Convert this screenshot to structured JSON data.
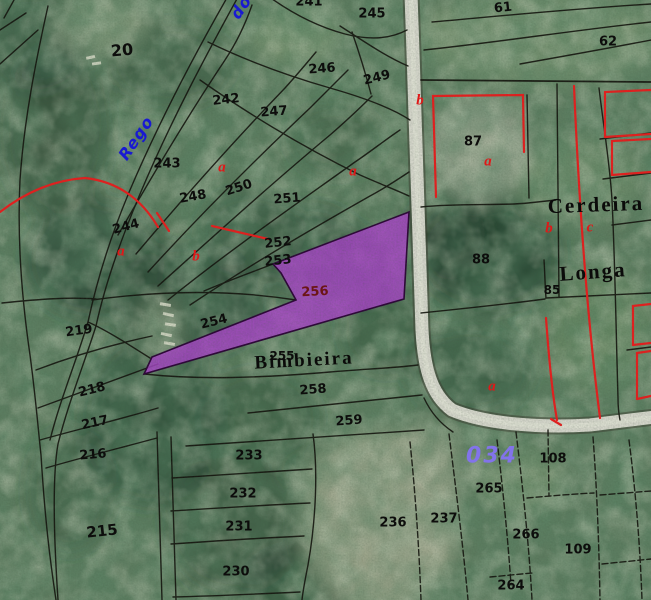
{
  "map": {
    "type": "cadastral-aerial-viewer",
    "highlighted_parcel": {
      "number": "256"
    },
    "colors": {
      "boundary": "#15150f",
      "red_boundary": "#e81e1e",
      "road": "#d5d6cb",
      "road_center": "#e1e2d6",
      "road_casing": "#3a3a2e",
      "highlight_fill": "#a844c8",
      "highlight_stroke": "#2d0638",
      "parcel_number": "#0d0d0c",
      "selected_number": "#6b1515",
      "place_name": "#0b0b0a",
      "zone_letter": "#e01818",
      "stream_text": "#1919d2",
      "sheet_number": "#8273ea"
    },
    "labels": [
      {
        "t": "20",
        "x": 122,
        "y": 50,
        "cls": "num",
        "r": -5,
        "s": 16
      },
      {
        "t": "241",
        "x": 309,
        "y": 2,
        "cls": "num",
        "r": 0
      },
      {
        "t": "245",
        "x": 372,
        "y": 14,
        "cls": "num",
        "r": 0
      },
      {
        "t": "246",
        "x": 322,
        "y": 69,
        "cls": "num",
        "r": -4
      },
      {
        "t": "249",
        "x": 377,
        "y": 78,
        "cls": "num",
        "r": -14
      },
      {
        "t": "242",
        "x": 226,
        "y": 100,
        "cls": "num",
        "r": -6
      },
      {
        "t": "247",
        "x": 274,
        "y": 112,
        "cls": "num",
        "r": -4
      },
      {
        "t": "243",
        "x": 167,
        "y": 164,
        "cls": "num",
        "r": 0
      },
      {
        "t": "248",
        "x": 193,
        "y": 197,
        "cls": "num",
        "r": -10
      },
      {
        "t": "250",
        "x": 239,
        "y": 188,
        "cls": "num",
        "r": -18
      },
      {
        "t": "251",
        "x": 287,
        "y": 199,
        "cls": "num",
        "r": -4
      },
      {
        "t": "244",
        "x": 126,
        "y": 227,
        "cls": "num",
        "r": -15
      },
      {
        "t": "252",
        "x": 278,
        "y": 243,
        "cls": "num",
        "r": -6
      },
      {
        "t": "253",
        "x": 278,
        "y": 261,
        "cls": "num",
        "r": -6
      },
      {
        "t": "256",
        "x": 315,
        "y": 292,
        "cls": "sel",
        "r": -3
      },
      {
        "t": "254",
        "x": 214,
        "y": 322,
        "cls": "num",
        "r": -14
      },
      {
        "t": "219",
        "x": 79,
        "y": 331,
        "cls": "num",
        "r": -8
      },
      {
        "t": "255",
        "x": 282,
        "y": 356,
        "cls": "num",
        "r": 0,
        "s": 12
      },
      {
        "t": "218",
        "x": 92,
        "y": 390,
        "cls": "num",
        "r": -14
      },
      {
        "t": "217",
        "x": 95,
        "y": 423,
        "cls": "num",
        "r": -12
      },
      {
        "t": "216",
        "x": 93,
        "y": 455,
        "cls": "num",
        "r": -5
      },
      {
        "t": "215",
        "x": 102,
        "y": 531,
        "cls": "num",
        "r": -6,
        "s": 15
      },
      {
        "t": "233",
        "x": 249,
        "y": 456,
        "cls": "num",
        "r": 0
      },
      {
        "t": "232",
        "x": 243,
        "y": 494,
        "cls": "num",
        "r": 0
      },
      {
        "t": "231",
        "x": 239,
        "y": 527,
        "cls": "num",
        "r": 0
      },
      {
        "t": "230",
        "x": 236,
        "y": 572,
        "cls": "num",
        "r": 0
      },
      {
        "t": "258",
        "x": 313,
        "y": 390,
        "cls": "num",
        "r": -4
      },
      {
        "t": "259",
        "x": 349,
        "y": 421,
        "cls": "num",
        "r": -4
      },
      {
        "t": "236",
        "x": 393,
        "y": 523,
        "cls": "num",
        "r": 0
      },
      {
        "t": "237",
        "x": 444,
        "y": 519,
        "cls": "num",
        "r": 0
      },
      {
        "t": "265",
        "x": 489,
        "y": 489,
        "cls": "num",
        "r": 0
      },
      {
        "t": "266",
        "x": 526,
        "y": 535,
        "cls": "num",
        "r": 0
      },
      {
        "t": "108",
        "x": 553,
        "y": 459,
        "cls": "num",
        "r": 0
      },
      {
        "t": "109",
        "x": 578,
        "y": 550,
        "cls": "num",
        "r": 0
      },
      {
        "t": "264",
        "x": 511,
        "y": 586,
        "cls": "num",
        "r": 0
      },
      {
        "t": "61",
        "x": 503,
        "y": 8,
        "cls": "num",
        "r": -6
      },
      {
        "t": "62",
        "x": 608,
        "y": 42,
        "cls": "num",
        "r": 0
      },
      {
        "t": "87",
        "x": 473,
        "y": 142,
        "cls": "num",
        "r": 0
      },
      {
        "t": "88",
        "x": 481,
        "y": 260,
        "cls": "num",
        "r": 0
      },
      {
        "t": "85",
        "x": 552,
        "y": 290,
        "cls": "num",
        "r": 0,
        "s": 12
      },
      {
        "t": "Cerdeira",
        "x": 596,
        "y": 205,
        "cls": "place",
        "r": -2
      },
      {
        "t": "Longa",
        "x": 593,
        "y": 272,
        "cls": "place",
        "r": -4
      },
      {
        "t": "Bimbieira",
        "x": 304,
        "y": 361,
        "cls": "place",
        "r": -3,
        "s": 19
      },
      {
        "t": "b",
        "x": 420,
        "y": 101,
        "cls": "red",
        "r": 0
      },
      {
        "t": "a",
        "x": 222,
        "y": 168,
        "cls": "red",
        "r": 0
      },
      {
        "t": "a",
        "x": 353,
        "y": 172,
        "cls": "red",
        "r": 0
      },
      {
        "t": "a",
        "x": 488,
        "y": 162,
        "cls": "red",
        "r": 0
      },
      {
        "t": "b",
        "x": 549,
        "y": 229,
        "cls": "red",
        "r": 0
      },
      {
        "t": "c",
        "x": 590,
        "y": 228,
        "cls": "red",
        "r": 0
      },
      {
        "t": "a",
        "x": 121,
        "y": 252,
        "cls": "red",
        "r": 0
      },
      {
        "t": "b",
        "x": 196,
        "y": 257,
        "cls": "red",
        "r": 0
      },
      {
        "t": "a",
        "x": 492,
        "y": 387,
        "cls": "red",
        "r": 0
      },
      {
        "t": "Rego",
        "x": 136,
        "y": 138,
        "cls": "blue",
        "r": -56
      },
      {
        "t": "do",
        "x": 241,
        "y": 7,
        "cls": "blue",
        "r": -56
      },
      {
        "t": "034",
        "x": 492,
        "y": 456,
        "cls": "sheet",
        "r": 0
      }
    ]
  }
}
